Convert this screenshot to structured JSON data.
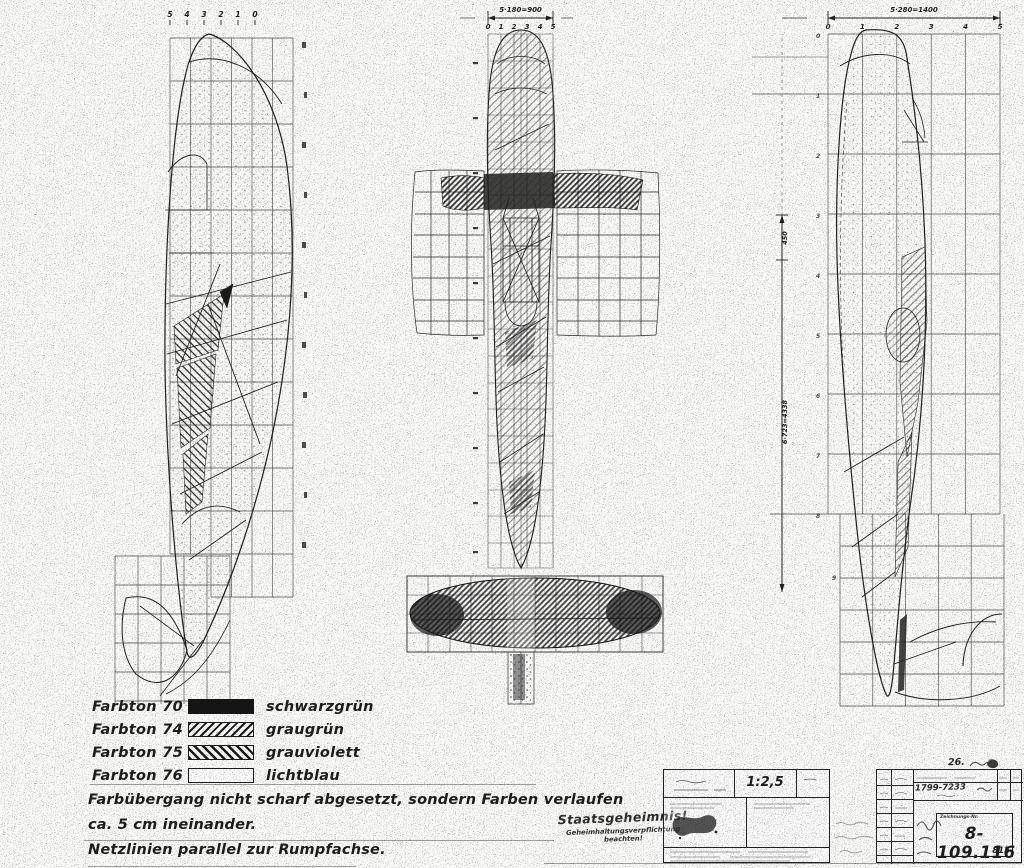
{
  "panels": {
    "left": {
      "ticks": [
        "5",
        "4",
        "3",
        "2",
        "1",
        "0"
      ]
    },
    "middle": {
      "width_dimension": "5·180=900",
      "ticks": [
        "0",
        "1",
        "2",
        "3",
        "4",
        "5"
      ]
    },
    "right": {
      "width_dimension": "5·280=1400",
      "ticks": [
        "0",
        "1",
        "2",
        "3",
        "4",
        "5"
      ],
      "vertical_dimension_segment": "450",
      "vertical_dimension_total": "6·723=4338",
      "row_numbers": [
        "0",
        "1",
        "2",
        "3",
        "4",
        "5",
        "6",
        "7",
        "8",
        "9"
      ]
    }
  },
  "legend": {
    "entries": [
      {
        "label": "Farbton 70",
        "swatch": "solid-black",
        "color_name": "schwarzgrün"
      },
      {
        "label": "Farbton 74",
        "swatch": "hatch-forward",
        "color_name": "graugrün"
      },
      {
        "label": "Farbton 75",
        "swatch": "hatch-back",
        "color_name": "grauviolett"
      },
      {
        "label": "Farbton 76",
        "swatch": "empty-white",
        "color_name": "lichtblau"
      }
    ]
  },
  "notes": {
    "line1": "Farbübergang nicht scharf abgesetzt, sondern Farben verlaufen",
    "line2": "ca. 5 cm ineinander.",
    "line3": "Netzlinien parallel zur Rumpfachse."
  },
  "title_block": {
    "secrecy_title": "Staatsgeheimnis!",
    "secrecy_sub1": "Geheimhaltungsverpflichtung",
    "secrecy_sub2": "beachten!",
    "scale": "1:2,5",
    "change_entry": "1799-7233",
    "drawing_number_label": "Zeichnungs-Nr.",
    "drawing_number": "8-109.116",
    "sheet_code": "815",
    "date_note": "26."
  }
}
